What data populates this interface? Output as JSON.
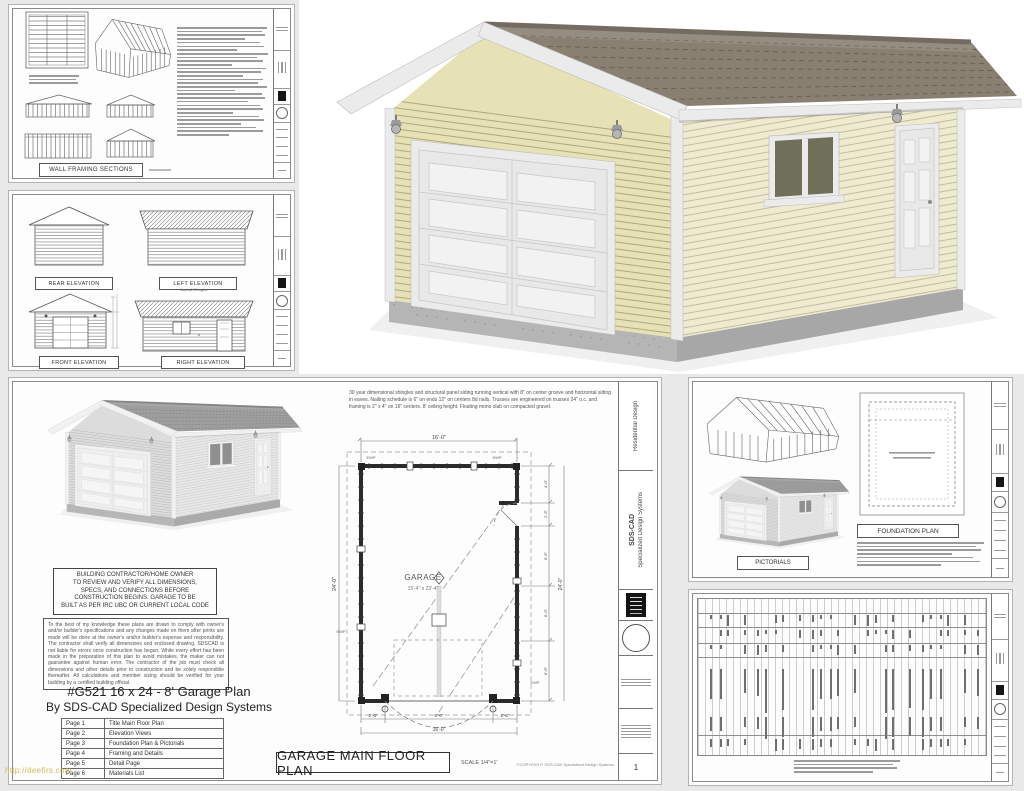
{
  "colors": {
    "canvas_bg": "#e9e9e9",
    "siding": "#e7e1b6",
    "roof": "#8a8072",
    "trim": "#ebebeb",
    "watermark_yellow": "#cfc054"
  },
  "watermark": "http://deefirs.com",
  "titleblock": {
    "company": "SDS-CAD",
    "company2": "Specialized Design Systems",
    "discipline": "Residential Design",
    "sheet_no": "1"
  },
  "wall_framing_sheet": {
    "title": "WALL FRAMING SECTIONS"
  },
  "elevation_sheet": {
    "labels": [
      "REAR ELEVATION",
      "LEFT ELEVATION",
      "FRONT ELEVATION",
      "RIGHT ELEVATION"
    ],
    "roof_note": "Asphalt Shingles"
  },
  "floor_plan_sheet": {
    "notes": "30 year dimensional shingles and structural panel siding running vertical with 8\" on center groove and horizontal siding in eaves.  Nailing schedule is 6\" on ends 12\" on centers 8d nails.  Trusses are engineered on trusses 24\" o.c. and framing is 2\" x 4\" on 16\" centers.  8' ceiling height.  Floating mono slab on compacted gravel.",
    "contractor_notice": "BUILDING CONTRACTOR/HOME OWNER\nTO REVIEW AND VERIFY ALL DIMENSIONS,\nSPECS, AND CONNECTIONS BEFORE\nCONSTRUCTION BEGINS. GARAGE TO BE\nBUILT AS PER IRC UBC OR CURRENT LOCAL CODE",
    "disclaimer": "To the best of my knowledge these plans are drawn to comply with owner's and/or builder's specifications and any changes made on them after prints are made will be done at the owner's and/or builder's expense and responsibility.  The contractor shall verify all dimensions and enclosed drawing.  SDSCAD is not liable for errors once construction has begun.  While every effort has been made in the preparation of this plan to avoid mistakes, the maker can not guarantee against human error.  The contractor of the job must check all dimensions and other details prior to construction and be solely responsible thereafter.  All calculations and member sizing should be verified for your building by a certified building official.",
    "title_line1": "#G521 16 x 24 - 8' Garage Plan",
    "title_line2": "By SDS-CAD Specialized Design Systems",
    "pages": [
      {
        "no": "Page 1",
        "name": "Title Main Floor Plan"
      },
      {
        "no": "Page 2",
        "name": "Elevation Views"
      },
      {
        "no": "Page 3",
        "name": "Foundation Plan & Pictorials"
      },
      {
        "no": "Page 4",
        "name": "Framing and Details"
      },
      {
        "no": "Page 5",
        "name": "Detail Page"
      },
      {
        "no": "Page 6",
        "name": "Materials List"
      }
    ],
    "footer_title": "GARAGE MAIN FLOOR PLAN",
    "footer_scale": "SCALE 1/4\"=1'",
    "footer_copyright": "©COPYRIGHT SDS-CAD Specialized Design Systems",
    "plan": {
      "room": "GARAGE",
      "room_size": "15'-4\" x 23'-4\"",
      "width": "16'-0\"",
      "depth": "24'-0\"",
      "door_left": "2'-6\"",
      "door_width": "9'-0\"",
      "door_right": "2'-6\"",
      "right_segs": [
        "4'-0\"",
        "2'-6\"",
        "6'-6\"",
        "6'-0\"",
        "6'-6\""
      ],
      "anchor": "EWP"
    }
  },
  "foundation_sheet": {
    "foundation_label": "FOUNDATION PLAN",
    "pictorials_label": "PICTORIALS"
  }
}
